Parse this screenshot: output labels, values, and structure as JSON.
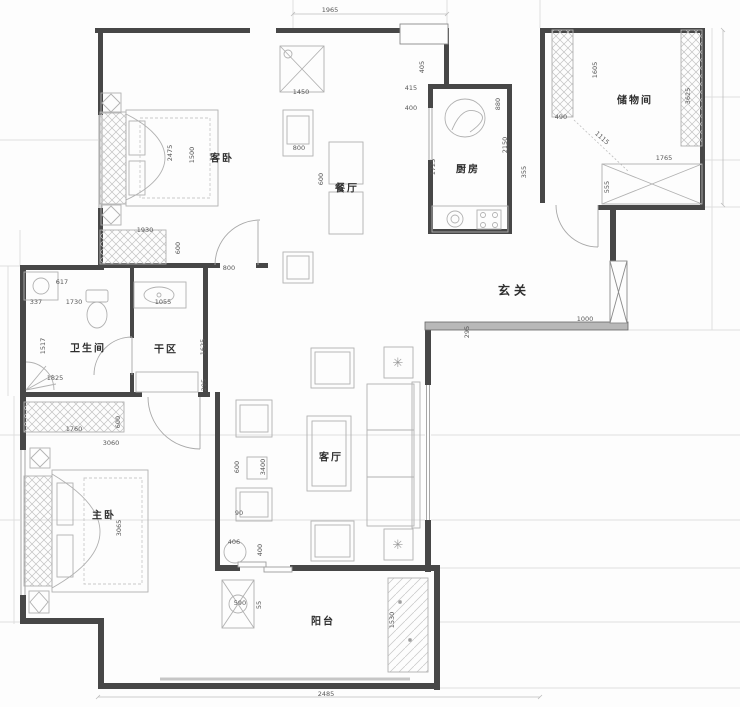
{
  "title": "apartment-floor-plan",
  "colors": {
    "wall": "#474747",
    "wallfill": "#b8b8b8",
    "furn": "#b1b1b1",
    "dimtext": "#585858",
    "labeltext": "#2e2e2e",
    "grid": "#dedede",
    "dimline": "#bdbdbd"
  },
  "rooms": [
    {
      "id": "guest-bedroom",
      "label": "客卧",
      "x": 222,
      "y": 157,
      "emphasis": false
    },
    {
      "id": "dining",
      "label": "餐厅",
      "x": 347,
      "y": 187,
      "emphasis": false
    },
    {
      "id": "kitchen",
      "label": "厨房",
      "x": 468,
      "y": 168,
      "emphasis": false
    },
    {
      "id": "storage",
      "label": "储物间",
      "x": 635,
      "y": 99,
      "emphasis": false
    },
    {
      "id": "foyer",
      "label": "玄关",
      "x": 514,
      "y": 290,
      "emphasis": true
    },
    {
      "id": "bathroom",
      "label": "卫生间",
      "x": 88,
      "y": 347,
      "emphasis": false
    },
    {
      "id": "dry-area",
      "label": "干区",
      "x": 166,
      "y": 348,
      "emphasis": false
    },
    {
      "id": "master-bedroom",
      "label": "主卧",
      "x": 104,
      "y": 514,
      "emphasis": false
    },
    {
      "id": "living-room",
      "label": "客厅",
      "x": 331,
      "y": 456,
      "emphasis": false
    },
    {
      "id": "balcony",
      "label": "阳台",
      "x": 323,
      "y": 620,
      "emphasis": false
    }
  ],
  "dimensions": [
    {
      "text": "1965",
      "x": 330,
      "y": 10,
      "rot": 0
    },
    {
      "text": "1450",
      "x": 301,
      "y": 92,
      "rot": 0
    },
    {
      "text": "405",
      "x": 422,
      "y": 67,
      "rot": -90
    },
    {
      "text": "415",
      "x": 411,
      "y": 88,
      "rot": 0
    },
    {
      "text": "400",
      "x": 411,
      "y": 108,
      "rot": 0
    },
    {
      "text": "880",
      "x": 498,
      "y": 104,
      "rot": -90
    },
    {
      "text": "2150",
      "x": 505,
      "y": 145,
      "rot": -90
    },
    {
      "text": "355",
      "x": 524,
      "y": 172,
      "rot": -90
    },
    {
      "text": "1725",
      "x": 433,
      "y": 167,
      "rot": -90
    },
    {
      "text": "1605",
      "x": 595,
      "y": 70,
      "rot": -90
    },
    {
      "text": "490",
      "x": 561,
      "y": 117,
      "rot": 0
    },
    {
      "text": "1115",
      "x": 602,
      "y": 138,
      "rot": 42
    },
    {
      "text": "1765",
      "x": 664,
      "y": 158,
      "rot": 0
    },
    {
      "text": "555",
      "x": 607,
      "y": 187,
      "rot": -90
    },
    {
      "text": "3625",
      "x": 688,
      "y": 96,
      "rot": -90
    },
    {
      "text": "2475",
      "x": 170,
      "y": 153,
      "rot": -90
    },
    {
      "text": "1500",
      "x": 192,
      "y": 155,
      "rot": -90
    },
    {
      "text": "1930",
      "x": 145,
      "y": 230,
      "rot": 0
    },
    {
      "text": "600",
      "x": 178,
      "y": 248,
      "rot": -90
    },
    {
      "text": "800",
      "x": 299,
      "y": 148,
      "rot": 0
    },
    {
      "text": "600",
      "x": 321,
      "y": 179,
      "rot": -90
    },
    {
      "text": "617",
      "x": 62,
      "y": 282,
      "rot": 0
    },
    {
      "text": "337",
      "x": 36,
      "y": 302,
      "rot": 0
    },
    {
      "text": "1730",
      "x": 74,
      "y": 302,
      "rot": 0
    },
    {
      "text": "1055",
      "x": 163,
      "y": 302,
      "rot": 0
    },
    {
      "text": "1517",
      "x": 43,
      "y": 346,
      "rot": -90
    },
    {
      "text": "1825",
      "x": 55,
      "y": 378,
      "rot": 0
    },
    {
      "text": "800",
      "x": 229,
      "y": 268,
      "rot": 0
    },
    {
      "text": "1625",
      "x": 203,
      "y": 347,
      "rot": -90
    },
    {
      "text": "295",
      "x": 204,
      "y": 385,
      "rot": -90
    },
    {
      "text": "1000",
      "x": 585,
      "y": 319,
      "rot": 0
    },
    {
      "text": "295",
      "x": 467,
      "y": 332,
      "rot": -90
    },
    {
      "text": "1760",
      "x": 74,
      "y": 429,
      "rot": 0
    },
    {
      "text": "600",
      "x": 118,
      "y": 422,
      "rot": -90
    },
    {
      "text": "3060",
      "x": 111,
      "y": 443,
      "rot": 0
    },
    {
      "text": "3065",
      "x": 119,
      "y": 528,
      "rot": -90
    },
    {
      "text": "600",
      "x": 237,
      "y": 467,
      "rot": -90
    },
    {
      "text": "3400",
      "x": 263,
      "y": 467,
      "rot": -90
    },
    {
      "text": "90",
      "x": 239,
      "y": 513,
      "rot": 0
    },
    {
      "text": "406",
      "x": 234,
      "y": 542,
      "rot": 0
    },
    {
      "text": "400",
      "x": 260,
      "y": 550,
      "rot": -90
    },
    {
      "text": "590",
      "x": 240,
      "y": 603,
      "rot": 0
    },
    {
      "text": "55",
      "x": 259,
      "y": 605,
      "rot": -90
    },
    {
      "text": "1530",
      "x": 392,
      "y": 620,
      "rot": -90
    },
    {
      "text": "2485",
      "x": 326,
      "y": 694,
      "rot": 0
    }
  ],
  "decor": {
    "plant_glyph": "✳"
  }
}
